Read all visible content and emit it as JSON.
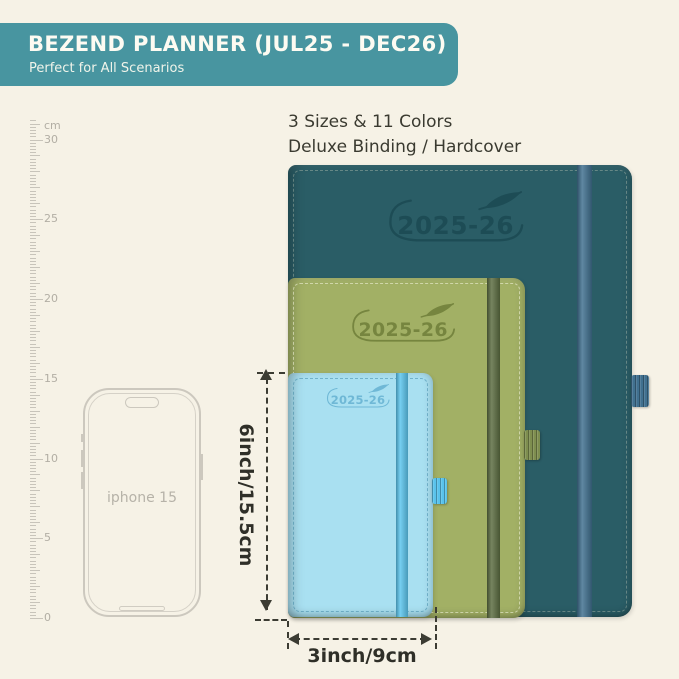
{
  "background": "#f6f2e6",
  "banner": {
    "title": "BEZEND PLANNER (JUL25 - DEC26)",
    "subtitle": "Perfect for All Scenarios",
    "bg": "#4895a0"
  },
  "intro": {
    "line1": "3 Sizes & 11 Colors",
    "line2": "Deluxe Binding / Hardcover"
  },
  "ruler": {
    "unit": "cm",
    "labels": [
      30,
      25,
      20,
      15,
      10,
      5,
      0
    ],
    "zero_y": 618,
    "px_per_cm": 15.95,
    "max_cm": 31.2
  },
  "phone": {
    "label": "iphone 15"
  },
  "planners": [
    {
      "id": "large",
      "year": "2025-26",
      "cover_color": "#2a5d66",
      "band_color": "#40708f",
      "loop_color": "#40708f",
      "logo_color": "#1d4c55"
    },
    {
      "id": "medium",
      "year": "2025-26",
      "cover_color": "#a2b065",
      "band_color": "#5c6d41",
      "loop_color": "#7e8e4f",
      "logo_color": "#76853f"
    },
    {
      "id": "small",
      "year": "2025-26",
      "cover_color": "#a9e0f1",
      "band_color": "#5cc6ee",
      "loop_color": "#59c3ec",
      "logo_color": "#6fb8d6"
    }
  ],
  "dimensions": {
    "height_label": "6inch/15.5cm",
    "width_label": "3inch/9cm"
  }
}
